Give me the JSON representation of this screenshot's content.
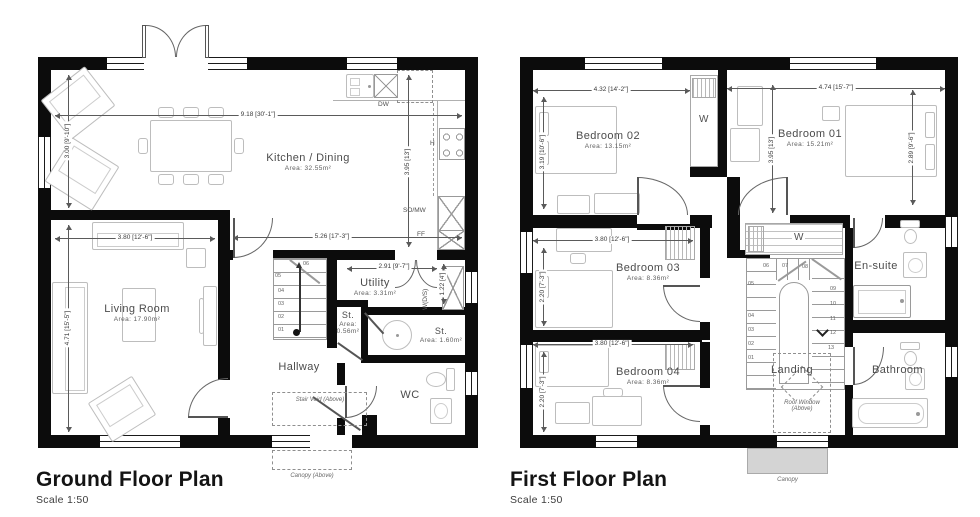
{
  "plans": {
    "ground": {
      "title": "Ground Floor Plan",
      "scale": "Scale 1:50",
      "rooms": {
        "kitchen": {
          "name": "Kitchen / Dining",
          "area": "Area: 32.55m²"
        },
        "living": {
          "name": "Living Room",
          "area": "Area: 17.90m²"
        },
        "hallway": {
          "name": "Hallway"
        },
        "utility": {
          "name": "Utility",
          "area": "Area: 3.31m²"
        },
        "store_small": {
          "name": "St.",
          "area": "Area: 0.56m²"
        },
        "store_large": {
          "name": "St.",
          "area": "Area: 1.60m²"
        },
        "wc": {
          "name": "WC"
        }
      },
      "dims": {
        "total_width": "9.18 [30'-1\"]",
        "kitchen_height": "3.00 [9'-10\"]",
        "kitchen_right_height": "3.95 [13']",
        "kitchen_lower_width": "5.26 [17'-3\"]",
        "living_width": "3.80 [12'-6\"]",
        "living_height": "4.71 [15'-5\"]",
        "utility_width": "2.91 [9'-7\"]",
        "utility_depth": "1.22 [4']"
      },
      "appliances": {
        "dishwasher": "DW",
        "hob": "H",
        "oven_microwave": "SO/MW",
        "fridge_freezer": "FF",
        "washer_dryer": "W(D/S)"
      },
      "annotations": {
        "stair_void": "Stair Void (Above)",
        "canopy": "Canopy (Above)"
      },
      "stairs": [
        "01",
        "02",
        "03",
        "04",
        "05",
        "06"
      ]
    },
    "first": {
      "title": "First Floor Plan",
      "scale": "Scale 1:50",
      "rooms": {
        "bedroom02": {
          "name": "Bedroom 02",
          "area": "Area: 13.15m²"
        },
        "bedroom01": {
          "name": "Bedroom 01",
          "area": "Area: 15.21m²"
        },
        "bedroom03": {
          "name": "Bedroom 03",
          "area": "Area: 8.36m²"
        },
        "bedroom04": {
          "name": "Bedroom 04",
          "area": "Area: 8.36m²"
        },
        "ensuite": {
          "name": "En-suite"
        },
        "bathroom": {
          "name": "Bathroom"
        },
        "landing": {
          "name": "Landing"
        }
      },
      "dims": {
        "bedroom02_width": "4.32 [14'-2\"]",
        "bedroom01_width": "4.74 [15'-7\"]",
        "bedroom02_height": "3.19 [10'-6\"]",
        "bedroom01_height": "3.95 [13']",
        "bedroom01_bed_width": "2.89 [9'-6\"]",
        "bedroom03_width": "3.80 [12'-6\"]",
        "bedroom03_height": "2.20 [7'-3\"]",
        "bedroom04_width": "3.80 [12'-6\"]",
        "bedroom04_height": "2.20 [7'-3\"]"
      },
      "wardrobes": {
        "w1": "W",
        "w2": "W"
      },
      "annotations": {
        "roof_window": "Roof Window (Above)",
        "canopy": "Canopy"
      },
      "stairs": [
        "01",
        "02",
        "03",
        "04",
        "05",
        "06",
        "07",
        "08",
        "09",
        "10",
        "11",
        "12",
        "13"
      ]
    }
  }
}
